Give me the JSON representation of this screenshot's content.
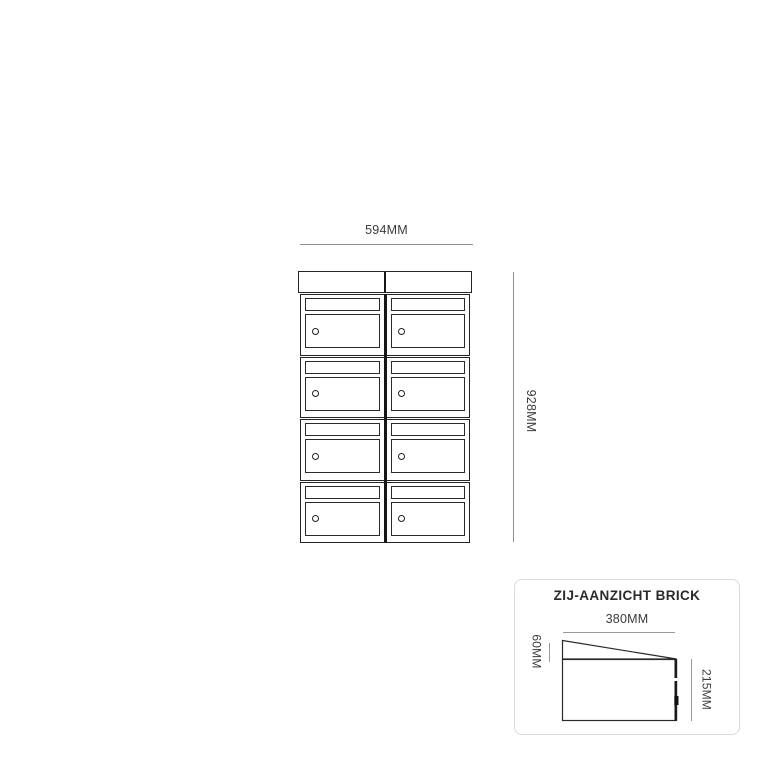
{
  "front_view": {
    "width_label": "594MM",
    "height_label": "928MM",
    "unit": {
      "columns": 2,
      "rows": 4,
      "module_count": 8,
      "module_features": [
        "letter-slot",
        "door",
        "lock-cylinder"
      ]
    }
  },
  "side_view": {
    "title": "ZIJ-AANZICHT BRICK",
    "width_label": "380MM",
    "roof_height_label": "60MM",
    "body_height_label": "215MM"
  },
  "colors": {
    "background": "#ffffff",
    "drawing_line": "#242424",
    "dimension_line": "#8f8f8f",
    "dimension_text": "#3a3a3a",
    "panel_border": "#d9d9d9"
  }
}
